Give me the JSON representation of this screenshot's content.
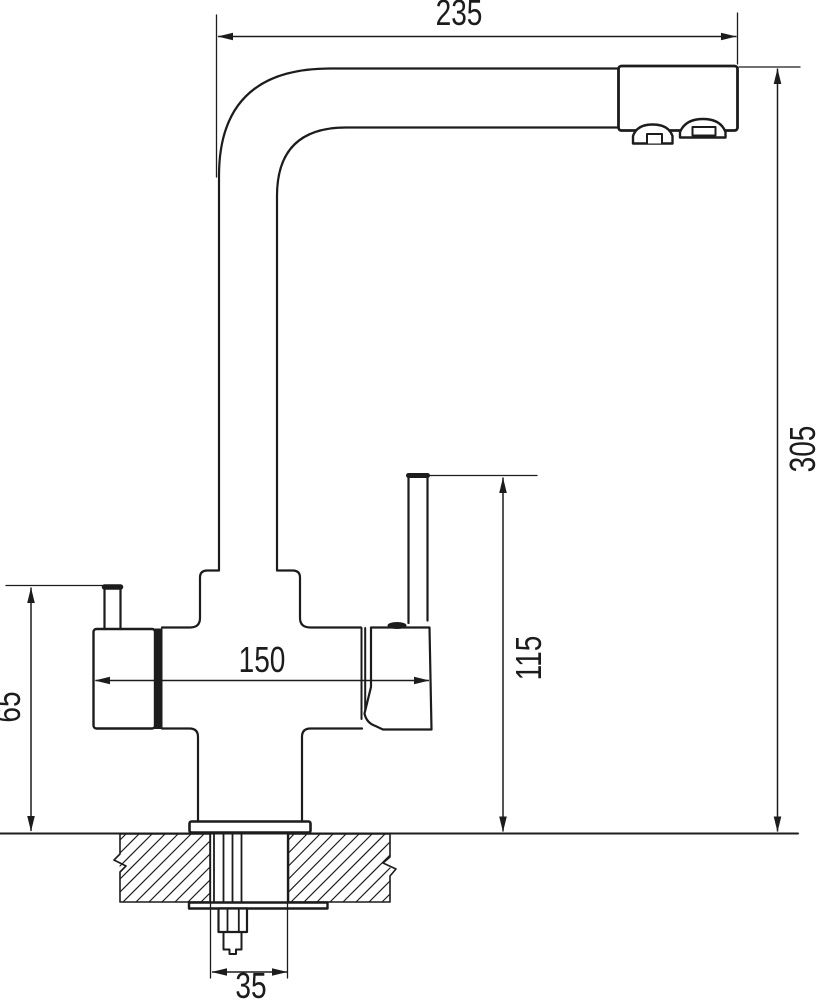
{
  "colors": {
    "line": "#1c1c1c",
    "background": "#ffffff"
  },
  "dimensions": [
    {
      "id": "spout-reach",
      "label": "235",
      "orientation": "horizontal"
    },
    {
      "id": "overall-height",
      "label": "305",
      "orientation": "vertical"
    },
    {
      "id": "body-width",
      "label": "150",
      "orientation": "horizontal"
    },
    {
      "id": "lever-top-height",
      "label": "115",
      "orientation": "vertical"
    },
    {
      "id": "side-handle-height",
      "label": "65",
      "orientation": "vertical"
    },
    {
      "id": "mounting-hole-width",
      "label": "35",
      "orientation": "horizontal"
    }
  ]
}
